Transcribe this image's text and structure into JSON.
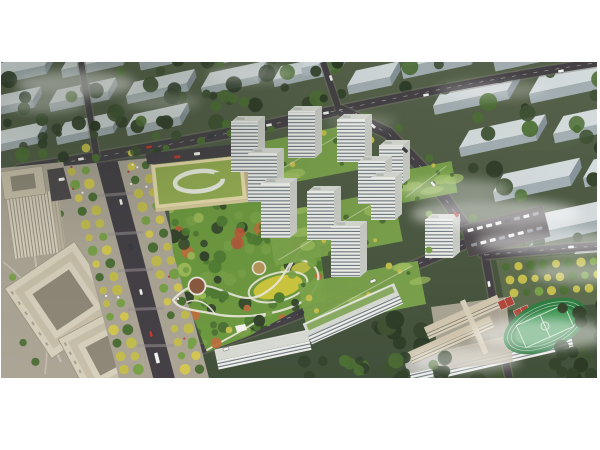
{
  "scene": {
    "type": "aerial-architectural-rendering",
    "view": "oblique bird's-eye masterplan of a residential development",
    "features": [
      "distant-city-blocks",
      "fog-wisps",
      "road-network",
      "tree-lined-mall",
      "central-park",
      "kindergarten",
      "residential-towers",
      "podium-gardens",
      "mid-rise-slabs",
      "office-buildings",
      "school-campus",
      "basketball-courts",
      "running-track-field",
      "parking-lots",
      "street-trees",
      "vehicles"
    ],
    "counts": {
      "residential_towers": 10,
      "mid_rise_slabs": 4,
      "office_buildings": 3,
      "school_buildings": 3,
      "basketball_courts": 2,
      "running_tracks": 1,
      "distant_blocks": 30
    },
    "palette": {
      "page_bg": "#ffffff",
      "ground": "#4e5a45",
      "ground_top": "#57624b",
      "ground_dark": "#41503a",
      "tree_dark": "#34432c",
      "tree_deep": "#2c3a26",
      "tree_mid": "#4d6f35",
      "tree_light": "#79a148",
      "tree_pale": "#9dbb57",
      "tree_yellow": "#c3bd4e",
      "tree_gold": "#d3c751",
      "tree_orange": "#bc6f3e",
      "tree_red": "#c1563c",
      "ghost_front": "#aeb9c2",
      "ghost_top": "#dbe1e5",
      "ghost_side": "#8d9aa5",
      "fog": "#ffffff",
      "road": "#454146",
      "road_light": "#5b5660",
      "mall_road": "#444046",
      "curb": "#7c776f",
      "lane_dash": "#d8d4c8",
      "crossing": "#989094",
      "path": "#ece8dd",
      "park_base": "#6d9940",
      "lawn_yellow": "#ccc63e",
      "plaza_brown": "#8a5a3f",
      "plaza_tan": "#b5975a",
      "tower_front": "#edeeea",
      "tower_stripe": "#55606a",
      "tower_side": "#c8cbc4",
      "tower_roof": "#d6d8d2",
      "podium_green": "#7ba34c",
      "podium_light": "#9ebd5f",
      "kinder_roof": "#95ad53",
      "kinder_wall": "#e7dbab",
      "kinder_side": "#c4b484",
      "office_wall": "#d7d0bd",
      "office_roof": "#c7bfa9",
      "office_dark": "#7a7466",
      "office_court": "#8e8878",
      "plaza_light": "#aca596",
      "school_wall": "#d6cdb8",
      "school_roof": "#cfc5ae",
      "pitch": "#3f9553",
      "track": "#2e7d43",
      "line_white": "#e9efe6",
      "court_red": "#b0473b",
      "car_white": "#f2f2f0",
      "car_red": "#c03a30",
      "car_dark": "#3a3f44",
      "lot_dark": "#4e494c"
    },
    "frame": {
      "width": 600,
      "height": 450,
      "margin_top": 62,
      "margin_bottom": 72,
      "margin_left": 1,
      "margin_right": 3
    }
  }
}
